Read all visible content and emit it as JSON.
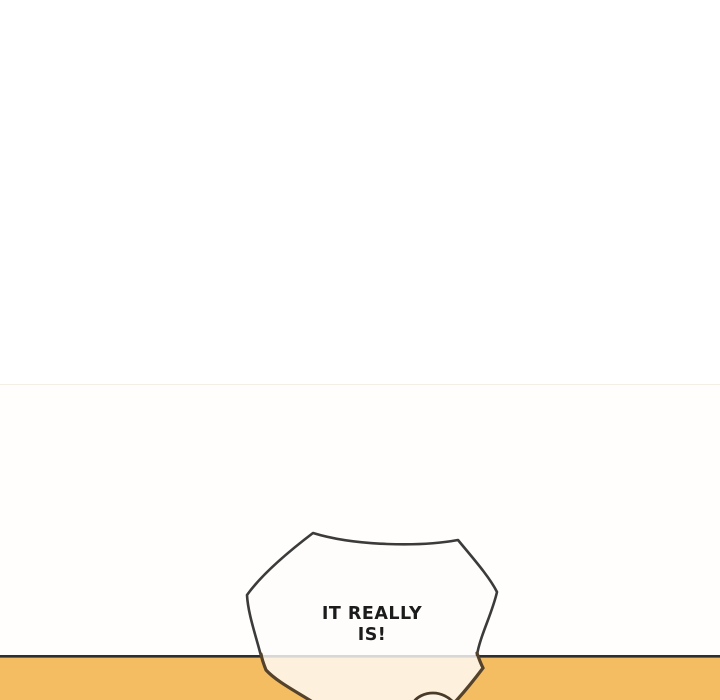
{
  "page": {
    "background_color": "#FFFFFF"
  },
  "panel": {
    "background_color": "#FFFEFC",
    "top_edge_color": "#F3EFE4",
    "floor_color": "#F5BD62",
    "ground_line_color": "#2F2F2F",
    "speech_bubble": {
      "text_lines": [
        "IT REALLY",
        "IS!"
      ],
      "full_text": "IT REALLY IS!",
      "fill_color": "rgba(255,253,250,0.82)",
      "outline_color": "#3B3B3B",
      "outline_over_floor_color": "#54422B",
      "text_color": "#1C1C1C"
    },
    "peeking_shape": {
      "fill_color": "#FBF4E6",
      "outline_color": "#4A3A28"
    }
  }
}
